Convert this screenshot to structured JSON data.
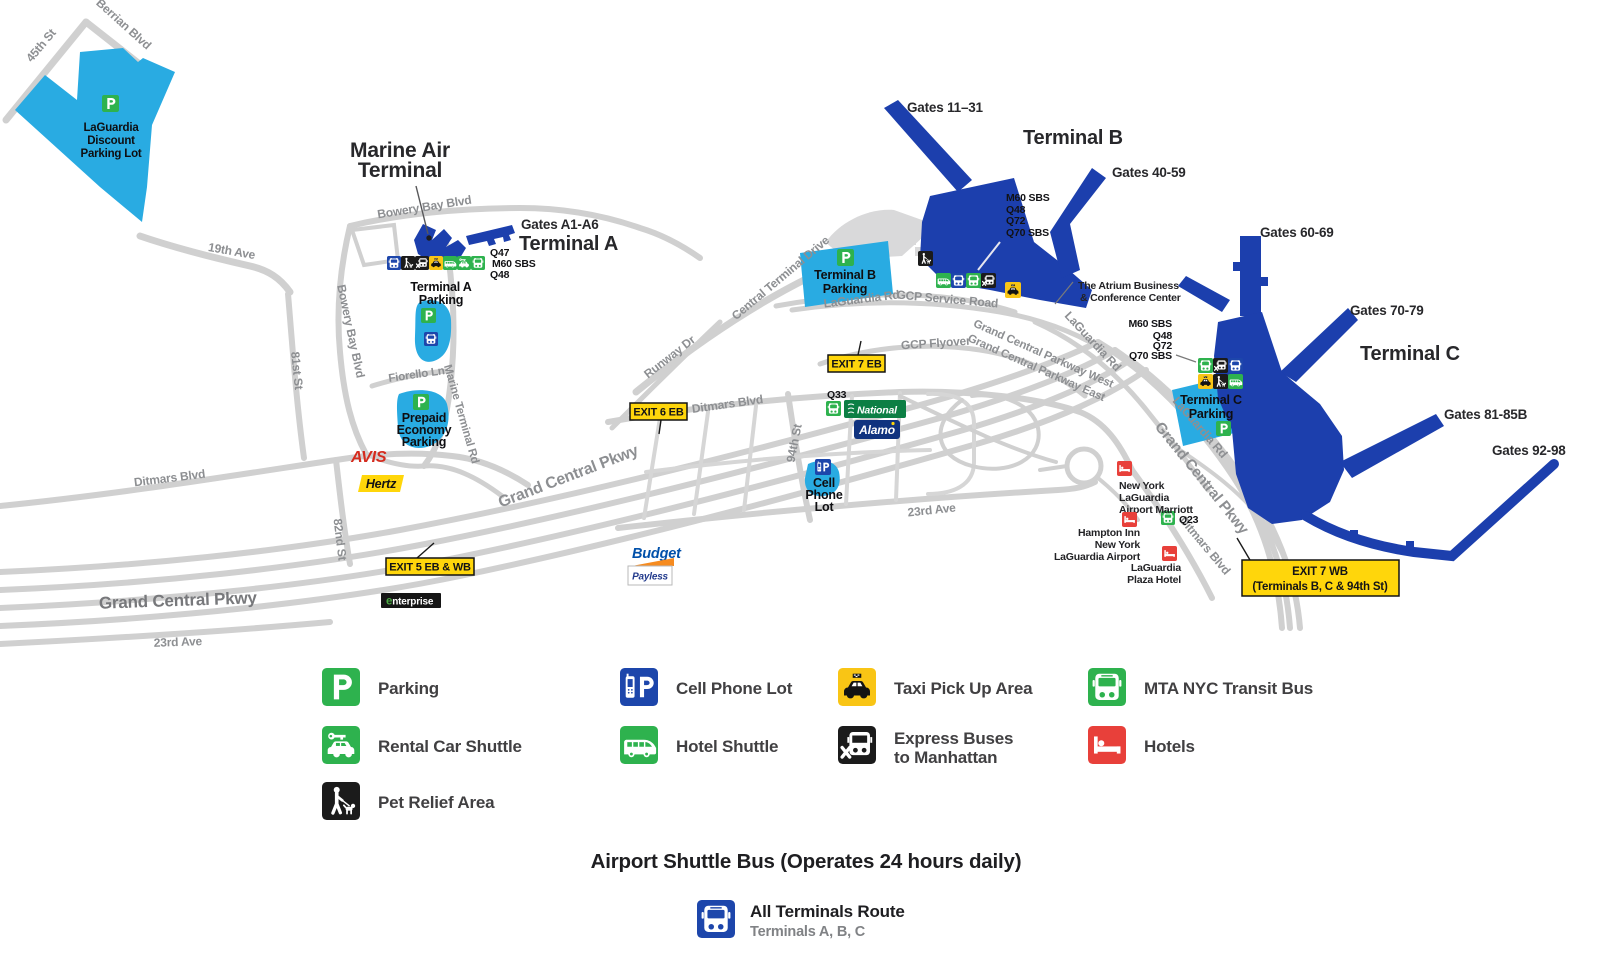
{
  "colors": {
    "terminal_blue": "#1c3fad",
    "parking_light_blue": "#29abe2",
    "icon_green": "#2eb24e",
    "icon_blue": "#1d46ab",
    "taxi_yellow": "#f9c515",
    "exit_yellow": "#ffd60b",
    "hotel_red": "#e8403a",
    "road_gray": "#d0d0d0"
  },
  "map": {
    "roads": {
      "st_45th": "45th St",
      "berrian_blvd": "Berrian Blvd",
      "ave_19th": "19th Ave",
      "st_81st": "81st St",
      "st_82nd": "82nd St",
      "bowery_bay_blvd": "Bowery Bay Blvd",
      "ditmars_blvd": "Ditmars Blvd",
      "fiorello_ln": "Fiorello Ln",
      "marine_terminal_rd": "Marine Terminal Rd",
      "grand_central_pkwy": "Grand Central Pkwy",
      "ave_23rd": "23rd Ave",
      "runway_dr": "Runway Dr",
      "central_terminal_drive": "Central Terminal Drive",
      "st_94th": "94th St",
      "gcp_service_road": "GCP Service Road",
      "gcp_flyover": "GCP Flyover",
      "gcp_west": "Grand Central Parkway West",
      "gcp_east": "Grand Central Parkway East",
      "laguardia_rd": "LaGuardia Rd"
    },
    "terminals": {
      "marine_air": {
        "line1": "Marine Air",
        "line2": "Terminal"
      },
      "terminal_a": {
        "name": "Terminal A",
        "gates": "Gates A1-A6"
      },
      "terminal_b": {
        "name": "Terminal B",
        "gates_11_31": "Gates 11–31",
        "gates_40_59": "Gates 40-59"
      },
      "terminal_c": {
        "name": "Terminal C",
        "gates_60_69": "Gates 60-69",
        "gates_70_79": "Gates 70-79",
        "gates_81_85b": "Gates 81-85B",
        "gates_92_98": "Gates 92-98"
      },
      "atrium": {
        "line1": "The Atrium Business",
        "line2": "& Conference Center"
      }
    },
    "parking": {
      "discount": [
        "LaGuardia",
        "Discount",
        "Parking Lot"
      ],
      "terminal_a": [
        "Terminal A",
        "Parking"
      ],
      "prepaid": [
        "Prepaid",
        "Economy",
        "Parking"
      ],
      "terminal_b": [
        "Terminal B",
        "Parking"
      ],
      "terminal_c": [
        "Terminal C",
        "Parking"
      ],
      "cell_phone_lot": [
        "Cell",
        "Phone",
        "Lot"
      ]
    },
    "bus_routes": {
      "terminal_a": [
        "Q47",
        "M60 SBS",
        "Q48"
      ],
      "terminal_b": [
        "M60 SBS",
        "Q48",
        "Q72",
        "Q70 SBS"
      ],
      "terminal_c": [
        "M60 SBS",
        "Q48",
        "Q72",
        "Q70 SBS"
      ],
      "q33": "Q33",
      "q23": "Q23"
    },
    "exits": {
      "exit5": "EXIT 5 EB & WB",
      "exit6": "EXIT 6 EB",
      "exit7eb": "EXIT 7 EB",
      "exit7wb_line1": "EXIT 7 WB",
      "exit7wb_line2": "(Terminals B, C & 94th St)"
    },
    "brands": {
      "avis": "AVIS",
      "hertz": "Hertz",
      "enterprise_e": "e",
      "enterprise_rest": "nterprise",
      "budget": "Budget",
      "payless": "Payless",
      "national": "National",
      "alamo": "Alamo"
    },
    "hotels": {
      "marriott": [
        "New York",
        "LaGuardia",
        "Airport Marriott"
      ],
      "hampton": [
        "Hampton Inn",
        "New York",
        "LaGuardia Airport"
      ],
      "plaza": [
        "LaGuardia",
        "Plaza Hotel"
      ]
    }
  },
  "legend": {
    "items": [
      {
        "icon": "parking-icon",
        "label": "Parking"
      },
      {
        "icon": "cell-phone-lot-icon",
        "label": "Cell Phone Lot"
      },
      {
        "icon": "taxi-icon",
        "label": "Taxi Pick Up Area"
      },
      {
        "icon": "transit-bus-icon",
        "label": "MTA NYC Transit Bus"
      },
      {
        "icon": "rental-car-shuttle-icon",
        "label": "Rental Car Shuttle"
      },
      {
        "icon": "hotel-shuttle-icon",
        "label": "Hotel Shuttle"
      },
      {
        "icon": "express-bus-icon",
        "label": "Express Buses",
        "label2": "to Manhattan"
      },
      {
        "icon": "hotels-icon",
        "label": "Hotels"
      },
      {
        "icon": "pet-relief-icon",
        "label": "Pet Relief Area"
      }
    ]
  },
  "shuttle": {
    "heading": "Airport Shuttle Bus (Operates 24 hours daily)",
    "route": "All Terminals Route",
    "route_terminals": "Terminals A, B, C"
  }
}
